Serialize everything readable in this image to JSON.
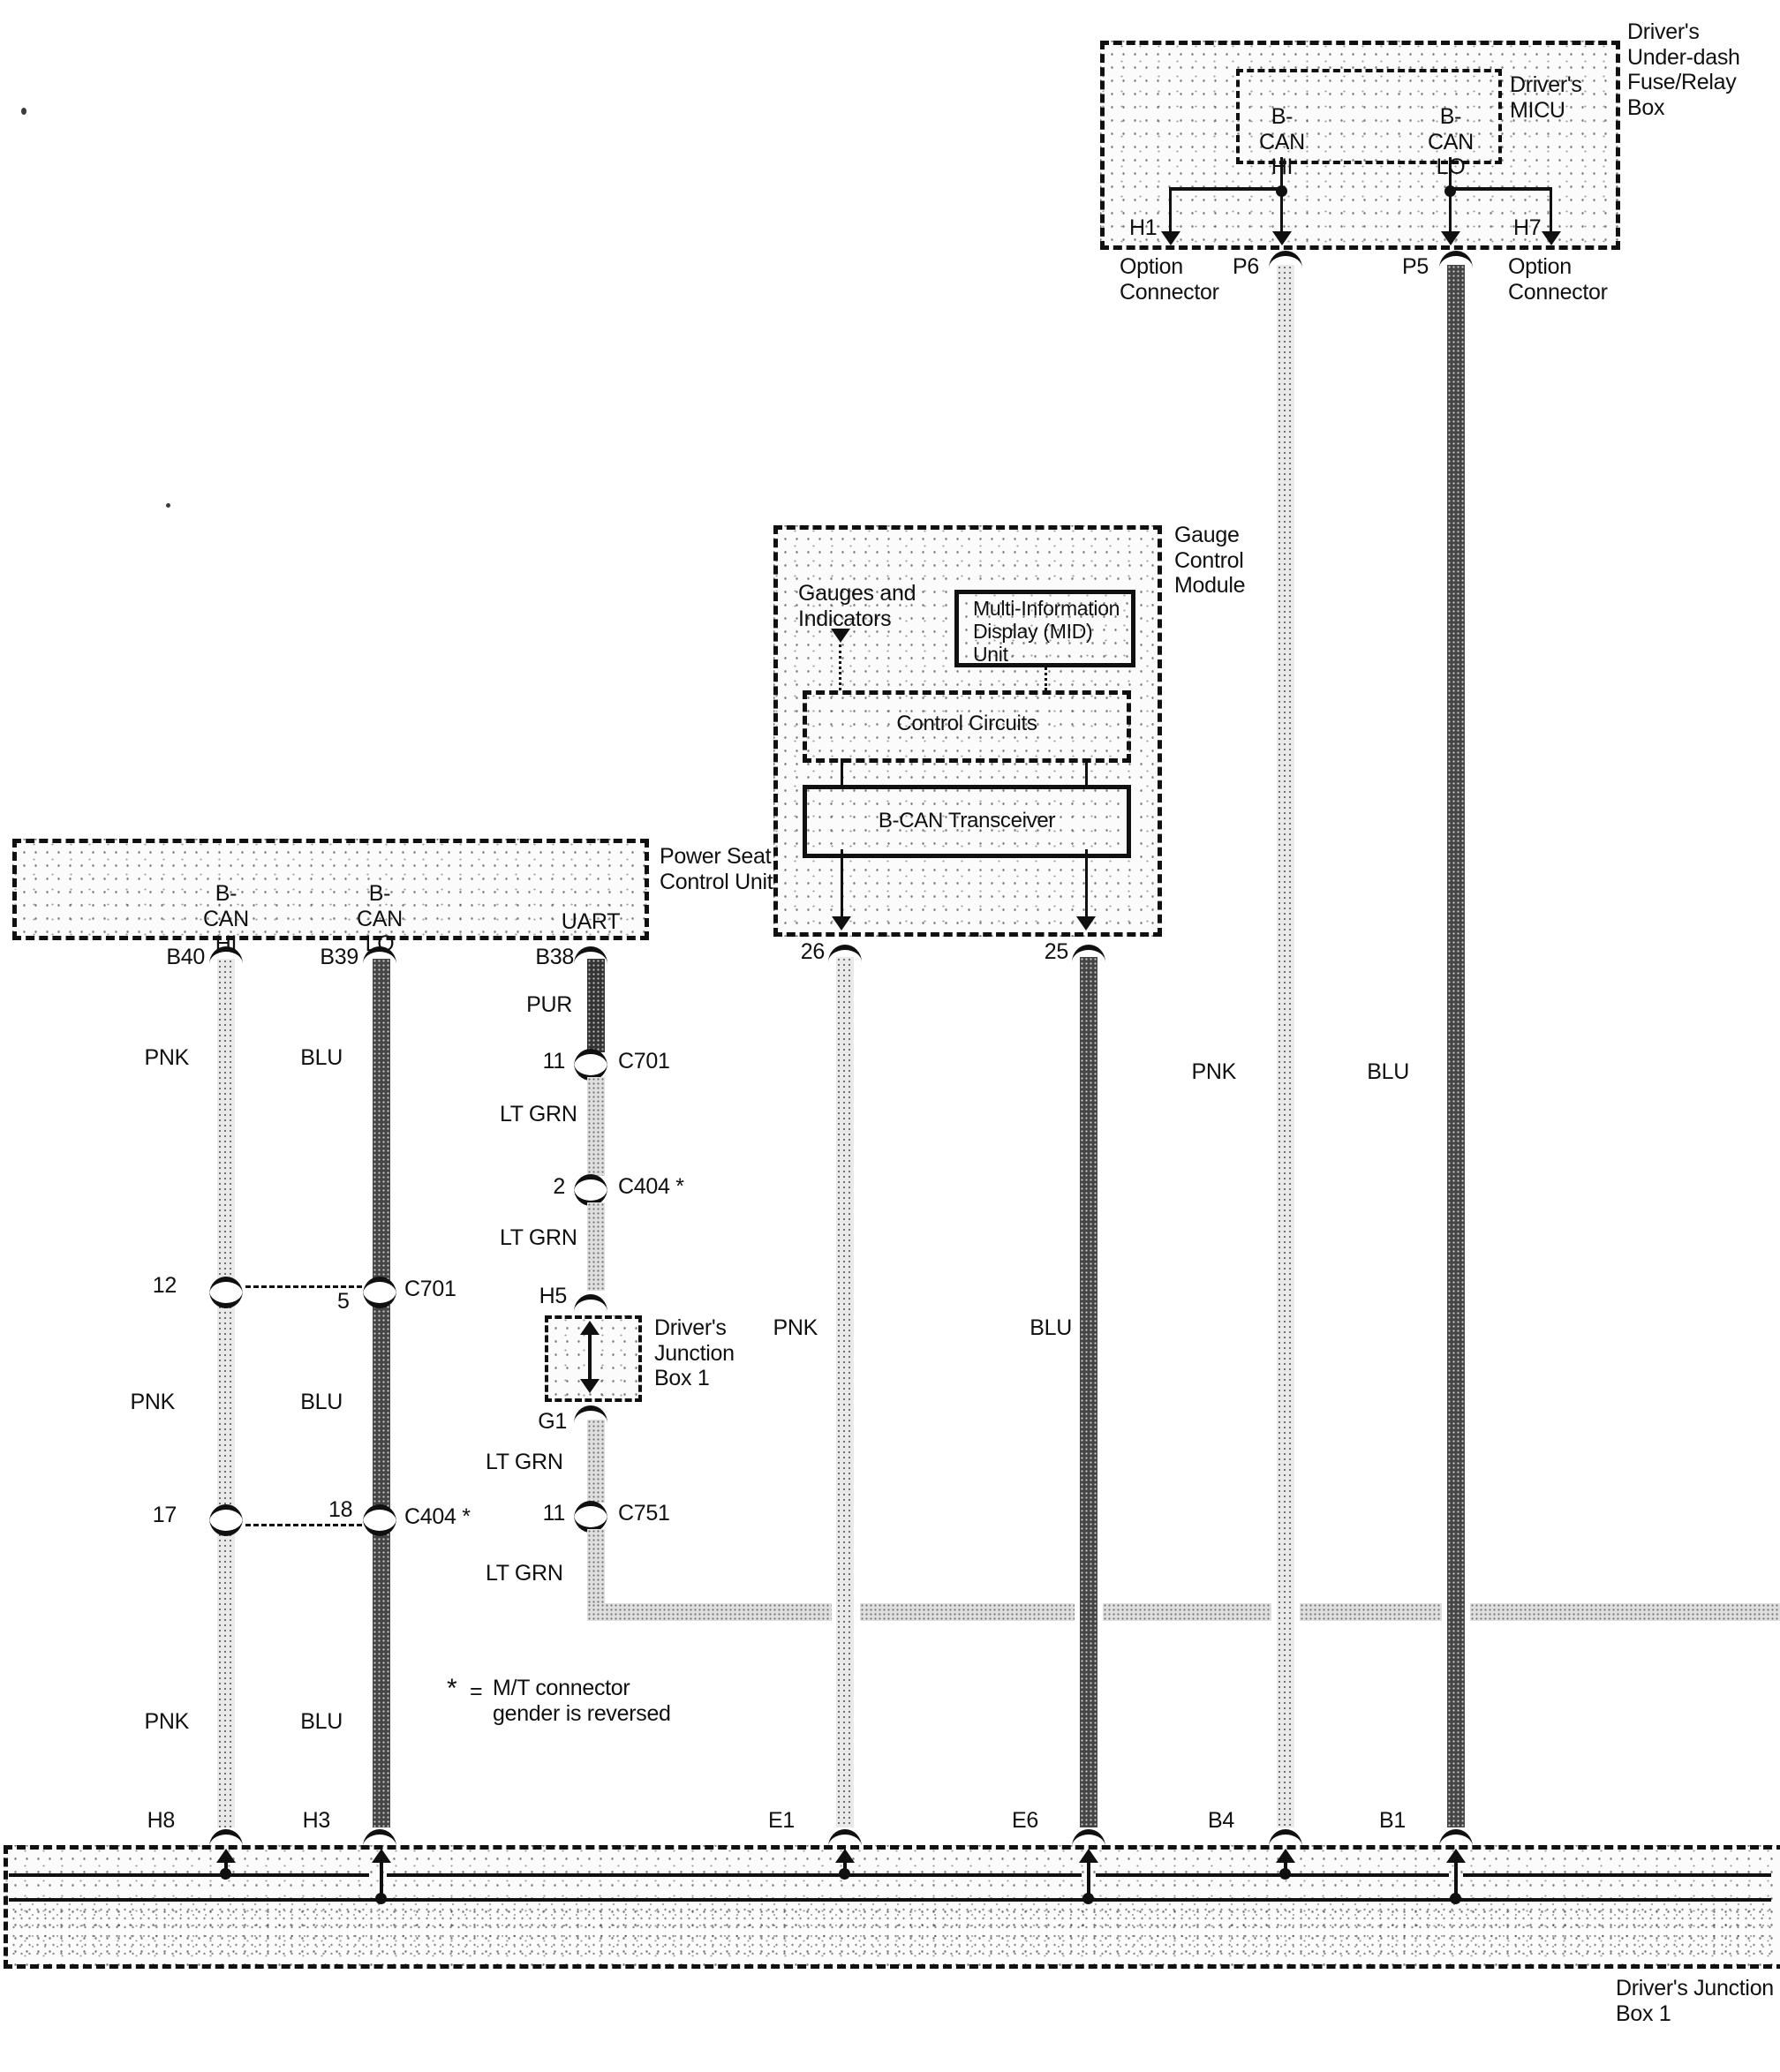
{
  "fuse_box": {
    "title": "Driver's\nUnder-dash\nFuse/Relay\nBox",
    "micu_title": "Driver's\nMICU",
    "bcan_hi": "B-CAN\nHI",
    "bcan_lo": "B-CAN\nLO",
    "pin_h1": "H1",
    "pin_h7": "H7",
    "pin_p6": "P6",
    "pin_p5": "P5",
    "option_connector": "Option\nConnector"
  },
  "gauge_module": {
    "title": "Gauge\nControl\nModule",
    "gauges_indicators": "Gauges and\nIndicators",
    "mid_unit": "Multi-Information\nDisplay (MID)\nUnit",
    "control_circuits": "Control Circuits",
    "transceiver": "B-CAN Transceiver",
    "pin_26": "26",
    "pin_25": "25"
  },
  "power_seat": {
    "title": "Power Seat\nControl Unit",
    "bcan_hi": "B-CAN\nHI",
    "bcan_lo": "B-CAN\nLO",
    "uart": "UART",
    "pin_b40": "B40",
    "pin_b39": "B39",
    "pin_b38": "B38"
  },
  "wire_colors": {
    "pnk": "PNK",
    "blu": "BLU",
    "pur": "PUR",
    "lt_grn": "LT GRN"
  },
  "connectors": {
    "c701_uart": {
      "pin": "11",
      "name": "C701"
    },
    "c404_uart": {
      "pin": "2",
      "name": "C404 *"
    },
    "c751_uart": {
      "pin": "11",
      "name": "C751"
    },
    "c701_pair": {
      "pin_left": "12",
      "pin_right": "5",
      "name": "C701"
    },
    "c404_pair": {
      "pin_left": "17",
      "pin_right": "18",
      "name": "C404 *"
    },
    "h5": "H5",
    "g1": "G1"
  },
  "junction_box_small": {
    "title": "Driver's\nJunction\nBox 1"
  },
  "junction_box_band": {
    "title": "Driver's Junction\nBox 1",
    "pins": {
      "h8": "H8",
      "h3": "H3",
      "e1": "E1",
      "e6": "E6",
      "b4": "B4",
      "b1": "B1"
    }
  },
  "note": {
    "symbol": "*",
    "equals": "=",
    "text": "M/T connector\ngender is reversed"
  }
}
